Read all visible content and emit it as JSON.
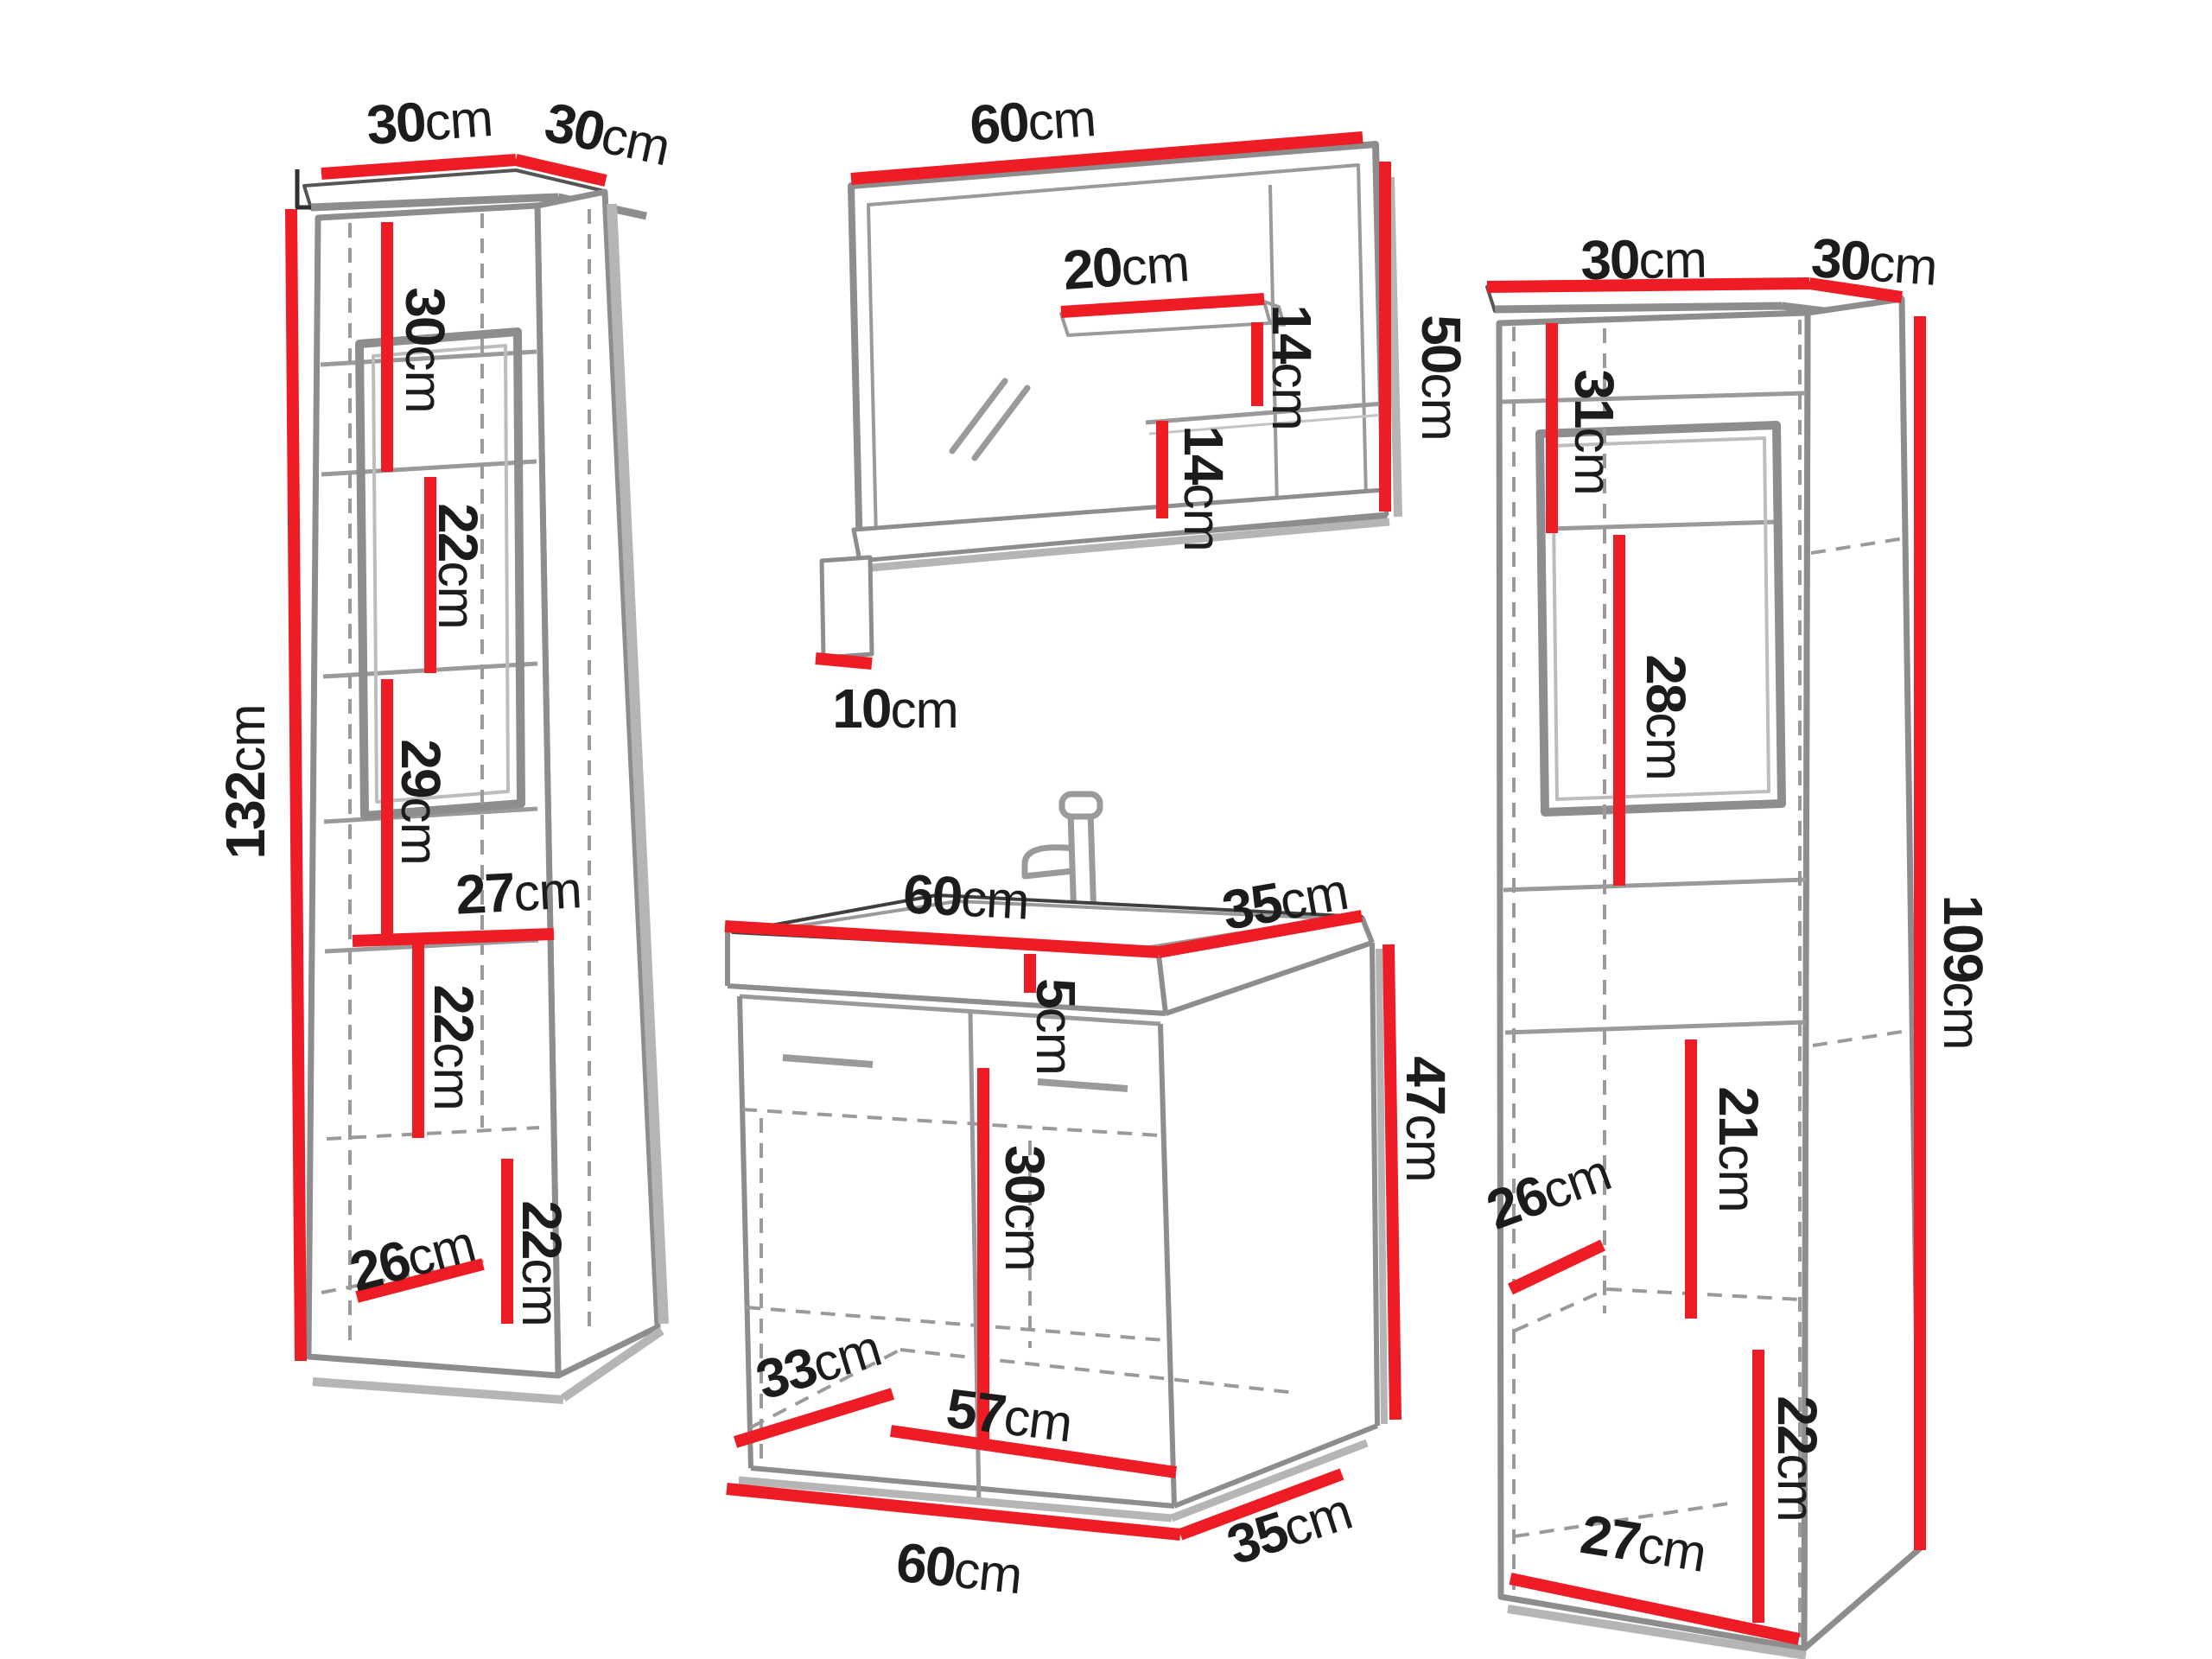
{
  "meta": {
    "type": "furniture-dimension-diagram",
    "subject": "bathroom furniture set: two tall side cabinets, mirror with shelves, and sink vanity unit",
    "background": "#ffffff"
  },
  "colors": {
    "dimension_red": "#ee1c25",
    "panel_gray": "#8d8d8d",
    "shadow_gray": "#b5b5b5",
    "dash_gray": "#9a9a9a",
    "text_dark": "#1c1c1c"
  },
  "pieces": [
    {
      "id": "tall-cabinet-left",
      "description": "tall storage cabinet, left",
      "width_cm": 30,
      "depth_cm": 30,
      "height_cm": 132,
      "section_dimensions_cm": [
        30,
        22,
        29,
        27,
        22,
        22,
        26
      ]
    },
    {
      "id": "mirror-with-shelves",
      "description": "wall mirror with side shelves and bottom ledge",
      "width_cm": 60,
      "height_cm": 50,
      "shelf_width_cm": 20,
      "shelf_gaps_cm": [
        14,
        14
      ],
      "ledge_depth_cm": 10
    },
    {
      "id": "sink-vanity",
      "description": "sink vanity cabinet with basin and two doors",
      "top_width_cm": 60,
      "top_depth_cm": 35,
      "basin_height_cm": 5,
      "body_height_cm": 47,
      "door_section_cm": 30,
      "inner_floor_cm": [
        57,
        33
      ],
      "base_cm": [
        60,
        35
      ]
    },
    {
      "id": "tall-cabinet-right",
      "description": "tall storage cabinet, right",
      "width_cm": 30,
      "depth_cm": 30,
      "height_cm": 109,
      "section_dimensions_cm": [
        31,
        28,
        21,
        26,
        22,
        27
      ]
    }
  ],
  "labels": {
    "lc_top_w": {
      "value": "30",
      "unit": "cm"
    },
    "lc_top_d": {
      "value": "30",
      "unit": "cm"
    },
    "lc_shelf_30": {
      "value": "30",
      "unit": "cm"
    },
    "lc_shelf_22a": {
      "value": "22",
      "unit": "cm"
    },
    "lc_shelf_29": {
      "value": "29",
      "unit": "cm"
    },
    "lc_width_27": {
      "value": "27",
      "unit": "cm"
    },
    "lc_shelf_22b": {
      "value": "22",
      "unit": "cm"
    },
    "lc_shelf_22c": {
      "value": "22",
      "unit": "cm"
    },
    "lc_depth_26": {
      "value": "26",
      "unit": "cm"
    },
    "lc_height_132": {
      "value": "132",
      "unit": "cm"
    },
    "mr_width_60": {
      "value": "60",
      "unit": "cm"
    },
    "mr_shelf_20": {
      "value": "20",
      "unit": "cm"
    },
    "mr_gap_14a": {
      "value": "14",
      "unit": "cm"
    },
    "mr_gap_14b": {
      "value": "14",
      "unit": "cm"
    },
    "mr_height_50": {
      "value": "50",
      "unit": "cm"
    },
    "mr_ledge_10": {
      "value": "10",
      "unit": "cm"
    },
    "sk_top_60": {
      "value": "60",
      "unit": "cm"
    },
    "sk_top_35": {
      "value": "35",
      "unit": "cm"
    },
    "sk_basin_5": {
      "value": "5",
      "unit": "cm"
    },
    "sk_height_47": {
      "value": "47",
      "unit": "cm"
    },
    "sk_door_30": {
      "value": "30",
      "unit": "cm"
    },
    "sk_floor_33": {
      "value": "33",
      "unit": "cm"
    },
    "sk_floor_57": {
      "value": "57",
      "unit": "cm"
    },
    "sk_bottom_60": {
      "value": "60",
      "unit": "cm"
    },
    "sk_bottom_35": {
      "value": "35",
      "unit": "cm"
    },
    "rc_top_w": {
      "value": "30",
      "unit": "cm"
    },
    "rc_top_d": {
      "value": "30",
      "unit": "cm"
    },
    "rc_shelf_31": {
      "value": "31",
      "unit": "cm"
    },
    "rc_shelf_28": {
      "value": "28",
      "unit": "cm"
    },
    "rc_shelf_21": {
      "value": "21",
      "unit": "cm"
    },
    "rc_depth_26": {
      "value": "26",
      "unit": "cm"
    },
    "rc_shelf_22": {
      "value": "22",
      "unit": "cm"
    },
    "rc_width_27": {
      "value": "27",
      "unit": "cm"
    },
    "rc_height_109": {
      "value": "109",
      "unit": "cm"
    }
  }
}
